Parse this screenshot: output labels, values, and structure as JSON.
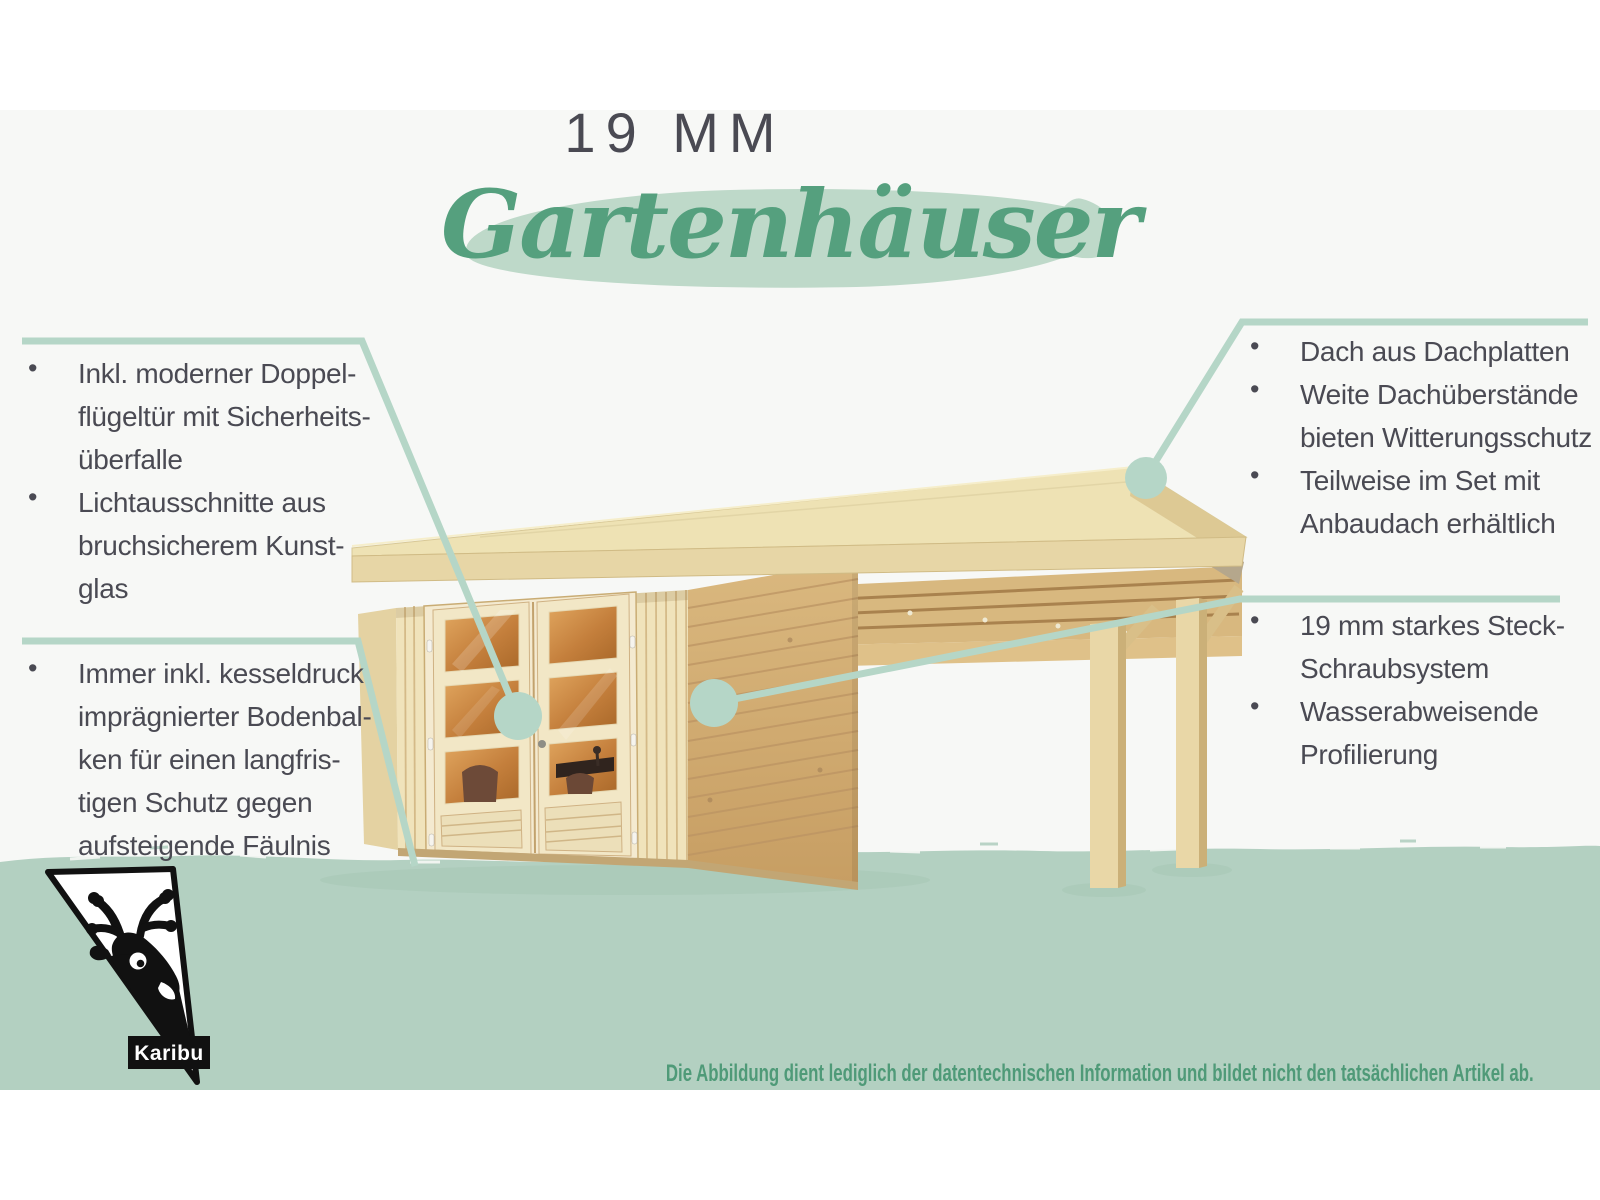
{
  "colors": {
    "background": "#f7f8f6",
    "accent_green": "#55a07e",
    "brush_green": "#bed9c9",
    "callout_green": "#b5d6c7",
    "band_green": "#b3d0c1",
    "text_dark": "#4a4a53",
    "disclaimer_green": "#4f9a78",
    "wood_cream": "#f0e3bb",
    "wood_tan": "#d2ab72",
    "glass_orange": "#c98440"
  },
  "header": {
    "kicker": "19 MM",
    "title": "Gartenhäuser"
  },
  "callouts": {
    "top_left": {
      "items": [
        {
          "text": "Inkl. moderner Doppel-\nflügeltür mit Sicherheits-\nüberfalle"
        },
        {
          "text": "Lichtausschnitte aus\nbruchsicherem Kunst-\nglas"
        }
      ]
    },
    "bottom_left": {
      "items": [
        {
          "text": "Immer inkl. kesseldruck\nimprägnierter Bodenbal-\nken für einen langfris-\ntigen Schutz gegen\naufsteigende Fäulnis"
        }
      ]
    },
    "top_right": {
      "items": [
        {
          "text": "Dach aus Dachplatten"
        },
        {
          "text": "Weite Dachüberstände\nbieten Witterungsschutz"
        },
        {
          "text": "Teilweise im Set mit\nAnbaudach erhältlich"
        }
      ]
    },
    "middle_right": {
      "items": [
        {
          "text": "19 mm starkes Steck-\nSchraubsystem"
        },
        {
          "text": "Wasserabweisende\nProfilierung"
        }
      ]
    }
  },
  "ui": {
    "bullet_glyph": "•"
  },
  "brand": {
    "logo_label": "Karibu",
    "logo_icon": "deer-head-icon"
  },
  "footer": {
    "disclaimer": "Die Abbildung dient lediglich der datentechnischen Information und bildet nicht den tatsächlichen Artikel ab."
  },
  "illustration": {
    "name": "garden-house-with-side-canopy"
  }
}
